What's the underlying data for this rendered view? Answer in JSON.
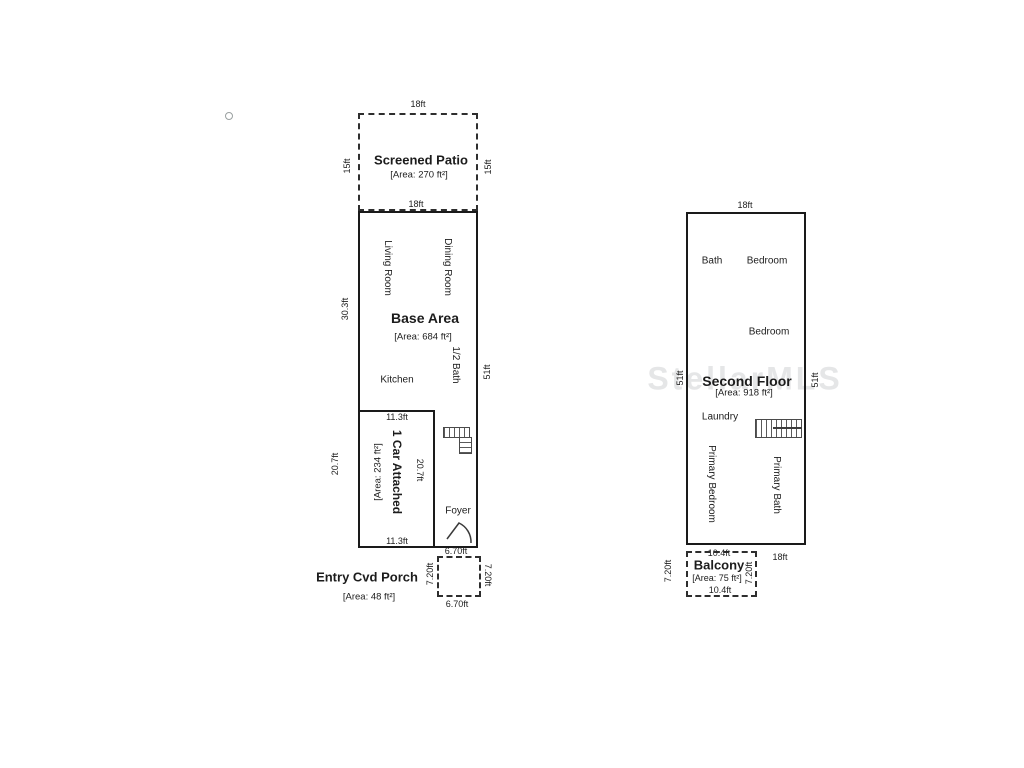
{
  "watermark": {
    "text": "StellarMLS"
  },
  "first_floor": {
    "patio": {
      "title": "Screened Patio",
      "area": "[Area: 270 ft²]",
      "dim_top": "18ft",
      "dim_left": "15ft",
      "dim_right": "15ft",
      "dim_bottom": "18ft"
    },
    "base": {
      "title": "Base Area",
      "area": "[Area: 684 ft²]",
      "dim_left_upper": "30.3ft",
      "dim_left_lower": "20.7ft",
      "dim_right": "51ft",
      "living_room": "Living Room",
      "dining_room": "Dining Room",
      "half_bath": "1/2 Bath",
      "kitchen": "Kitchen",
      "foyer": "Foyer"
    },
    "garage": {
      "title": "1 Car Attached",
      "area": "[Area: 234 ft²]",
      "dim_top": "11.3ft",
      "dim_bottom": "11.3ft",
      "dim_inner": "20.7ft"
    },
    "porch": {
      "title": "Entry Cvd Porch",
      "area": "[Area: 48 ft²]",
      "dim_top": "6.70ft",
      "dim_bottom": "6.70ft",
      "dim_left": "7.20ft",
      "dim_right": "7.20ft"
    }
  },
  "second_floor": {
    "title": "Second Floor",
    "area": "[Area: 918 ft²]",
    "dim_top": "18ft",
    "dim_left": "51ft",
    "dim_right": "51ft",
    "dim_bottom": "18ft",
    "bath": "Bath",
    "bedroom_1": "Bedroom",
    "bedroom_2": "Bedroom",
    "laundry": "Laundry",
    "primary_bedroom": "Primary Bedroom",
    "primary_bath": "Primary Bath",
    "balcony": {
      "title": "Balcony",
      "area": "[Area: 75 ft²]",
      "dim_top": "10.4ft",
      "dim_bottom": "10.4ft",
      "dim_left": "7.20ft",
      "dim_right": "7.20ft"
    }
  }
}
